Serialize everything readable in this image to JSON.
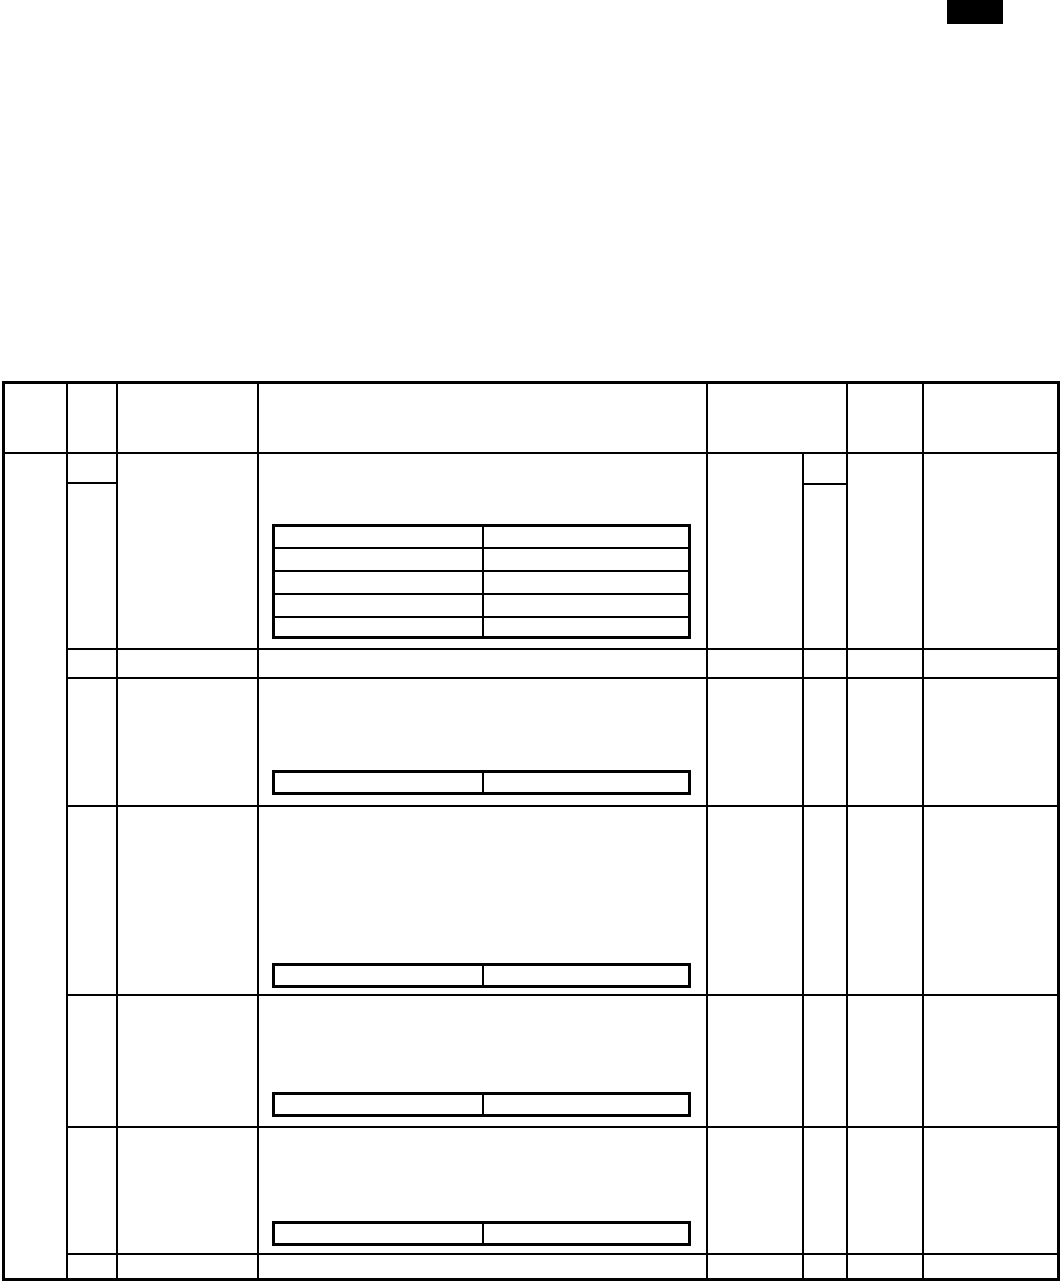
{
  "page": {
    "background_color": "#ffffff",
    "ink_color": "#000000",
    "visible_text": "",
    "description": "Blank ruled table page; every cell is empty"
  },
  "top_right_marker": {
    "type": "solid-black-rectangle"
  },
  "main_table": {
    "header_row_count": 1,
    "header_column_count": 7,
    "body_row_count": 7,
    "first_column_merged_over_body": true,
    "all_cells_empty": true,
    "nested_tables": [
      {
        "location": "body-row-1-col-4",
        "rows": 5,
        "cols": 2
      },
      {
        "location": "body-row-3-col-4",
        "rows": 1,
        "cols": 2
      },
      {
        "location": "body-row-4-col-4",
        "rows": 1,
        "cols": 2
      },
      {
        "location": "body-row-5-col-4",
        "rows": 1,
        "cols": 2
      },
      {
        "location": "body-row-6-col-4",
        "rows": 1,
        "cols": 2
      }
    ]
  }
}
